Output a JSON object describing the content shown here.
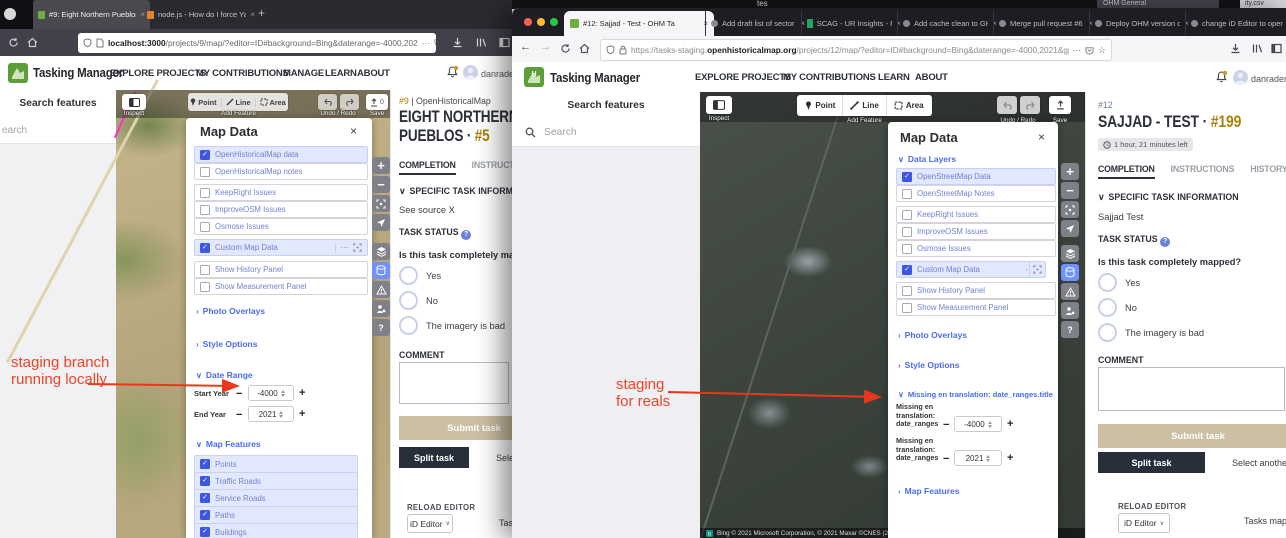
{
  "background": {
    "top_text": "tes",
    "back_tab": "OHM General",
    "back_tab_extra": "ity.csv"
  },
  "annotations": {
    "left_line1": "staging branch",
    "left_line2": "running locally",
    "right_line1": "staging",
    "right_line2": "for reals"
  },
  "left_window": {
    "tab1": "#9: Eight Northern Pueblos - T",
    "tab2": "node.js - How do I force Yarn t",
    "url_host": "localhost:3000",
    "url_rest": "/projects/9/map/?editor=ID#background=Bing&daterange=-4000,202",
    "brand": "Tasking Manager",
    "nav": [
      "EXPLORE PROJECTS",
      "MY CONTRIBUTIONS",
      "MANAGE",
      "LEARN",
      "ABOUT"
    ],
    "user": "danrade",
    "sidebar_title": "Search features",
    "sidebar_search": "earch",
    "toolbar": {
      "inspect": "Inspect",
      "point": "Point",
      "line": "Line",
      "area": "Area",
      "add_feature": "Add Feature",
      "undo_redo": "Undo / Redo",
      "save": "Save",
      "save_count": "0"
    },
    "panel": {
      "title": "Map Data",
      "data_layers": "Data Layers",
      "layers": [
        {
          "label": "OpenHistoricalMap data",
          "checked": true
        },
        {
          "label": "OpenHistoricalMap notes",
          "checked": false
        },
        {
          "label": "KeepRight Issues",
          "checked": false
        },
        {
          "label": "ImproveOSM Issues",
          "checked": false
        },
        {
          "label": "Osmose Issues",
          "checked": false
        },
        {
          "label": "Custom Map Data",
          "checked": true
        },
        {
          "label": "Show History Panel",
          "checked": false
        },
        {
          "label": "Show Measurement Panel",
          "checked": false
        }
      ],
      "ellipsis": "⋯",
      "photo_overlays": "Photo Overlays",
      "style_options": "Style Options",
      "date_range": "Date Range",
      "start_label": "Start Year",
      "start_value": "-4000",
      "end_label": "End Year",
      "end_value": "2021",
      "map_features": "Map Features",
      "features": [
        "Points",
        "Traffic Roads",
        "Service Roads",
        "Paths",
        "Buildings",
        "Building Parts"
      ]
    },
    "task": {
      "project_num": "#9",
      "sep": "|",
      "org": "OpenHistoricalMap",
      "title": "EIGHT NORTHERN PUEBLOS ·",
      "task_num": "#5",
      "tab_completion": "COMPLETION",
      "tab_instructions": "INSTRUCTIONS",
      "specific": "SPECIFIC TASK INFORMATION",
      "info": "See source X",
      "status": "TASK STATUS",
      "question": "Is this task completely mapped?",
      "opt_yes": "Yes",
      "opt_no": "No",
      "opt_bad": "The imagery is bad",
      "comment": "COMMENT",
      "submit": "Submit task",
      "split": "Split task",
      "select_another": "Select another task",
      "reload": "RELOAD EDITOR",
      "editor": "iD Editor",
      "tasks_map": "Tasks map"
    }
  },
  "right_window": {
    "tabs": [
      "#12: Sajjad - Test - OHM Ta",
      "Add draft list of sector type",
      "SCAG - UR Insights - Featu",
      "Add cache clean to GH Acti",
      "Merge pull request #6 from",
      "Deploy OHM version of iD i",
      "change iD Editor to openhi"
    ],
    "url_pre": "https://tasks-staging.",
    "url_host": "openhistoricalmap.org",
    "url_rest": "/projects/12/map/?editor=ID#background=Bing&daterange=-4000,2021&gpx=https://staging-tm",
    "brand": "Tasking Manager",
    "nav": [
      "EXPLORE PROJECTS",
      "MY CONTRIBUTIONS",
      "LEARN",
      "ABOUT"
    ],
    "user": "danradema",
    "sidebar_title": "Search features",
    "sidebar_search": "Search",
    "toolbar": {
      "inspect": "Inspect",
      "point": "Point",
      "line": "Line",
      "area": "Area",
      "add_feature": "Add Feature",
      "undo_redo": "Undo / Redo",
      "save": "Save"
    },
    "panel": {
      "title": "Map Data",
      "data_layers": "Data Layers",
      "layers": [
        {
          "label": "OpenStreetMap Data",
          "checked": true
        },
        {
          "label": "OpenStreetMap Notes",
          "checked": false
        },
        {
          "label": "KeepRight Issues",
          "checked": false
        },
        {
          "label": "ImproveOSM Issues",
          "checked": false
        },
        {
          "label": "Osmose Issues",
          "checked": false
        },
        {
          "label": "Custom Map Data",
          "checked": true
        },
        {
          "label": "Show History Panel",
          "checked": false
        },
        {
          "label": "Show Measurement Panel",
          "checked": false
        }
      ],
      "ellipsis": "⋯",
      "photo_overlays": "Photo Overlays",
      "style_options": "Style Options",
      "missing_title": "Missing en translation: date_ranges.title",
      "missing_l1": "Missing en",
      "missing_l2": "translation:",
      "missing_l3": "date_ranges",
      "start_value": "-4000",
      "end_value": "2021",
      "map_features": "Map Features"
    },
    "attribution": "Bing   © 2021 Microsoft Corporation, © 2021 Maxar  ©CNES (2021)",
    "task": {
      "project_num": "#12",
      "title": "SAJJAD - TEST ·",
      "task_num": "#199",
      "timer": "1 hour, 21 minutes left",
      "tab_completion": "COMPLETION",
      "tab_instructions": "INSTRUCTIONS",
      "tab_history": "HISTORY",
      "specific": "SPECIFIC TASK INFORMATION",
      "info": "Sajjad Test",
      "status": "TASK STATUS",
      "question": "Is this task completely mapped?",
      "opt_yes": "Yes",
      "opt_no": "No",
      "opt_bad": "The imagery is bad",
      "comment": "COMMENT",
      "submit": "Submit task",
      "split": "Split task",
      "select_another": "Select another t",
      "reload": "RELOAD EDITOR",
      "editor": "iD Editor",
      "tasks_map": "Tasks map"
    }
  }
}
